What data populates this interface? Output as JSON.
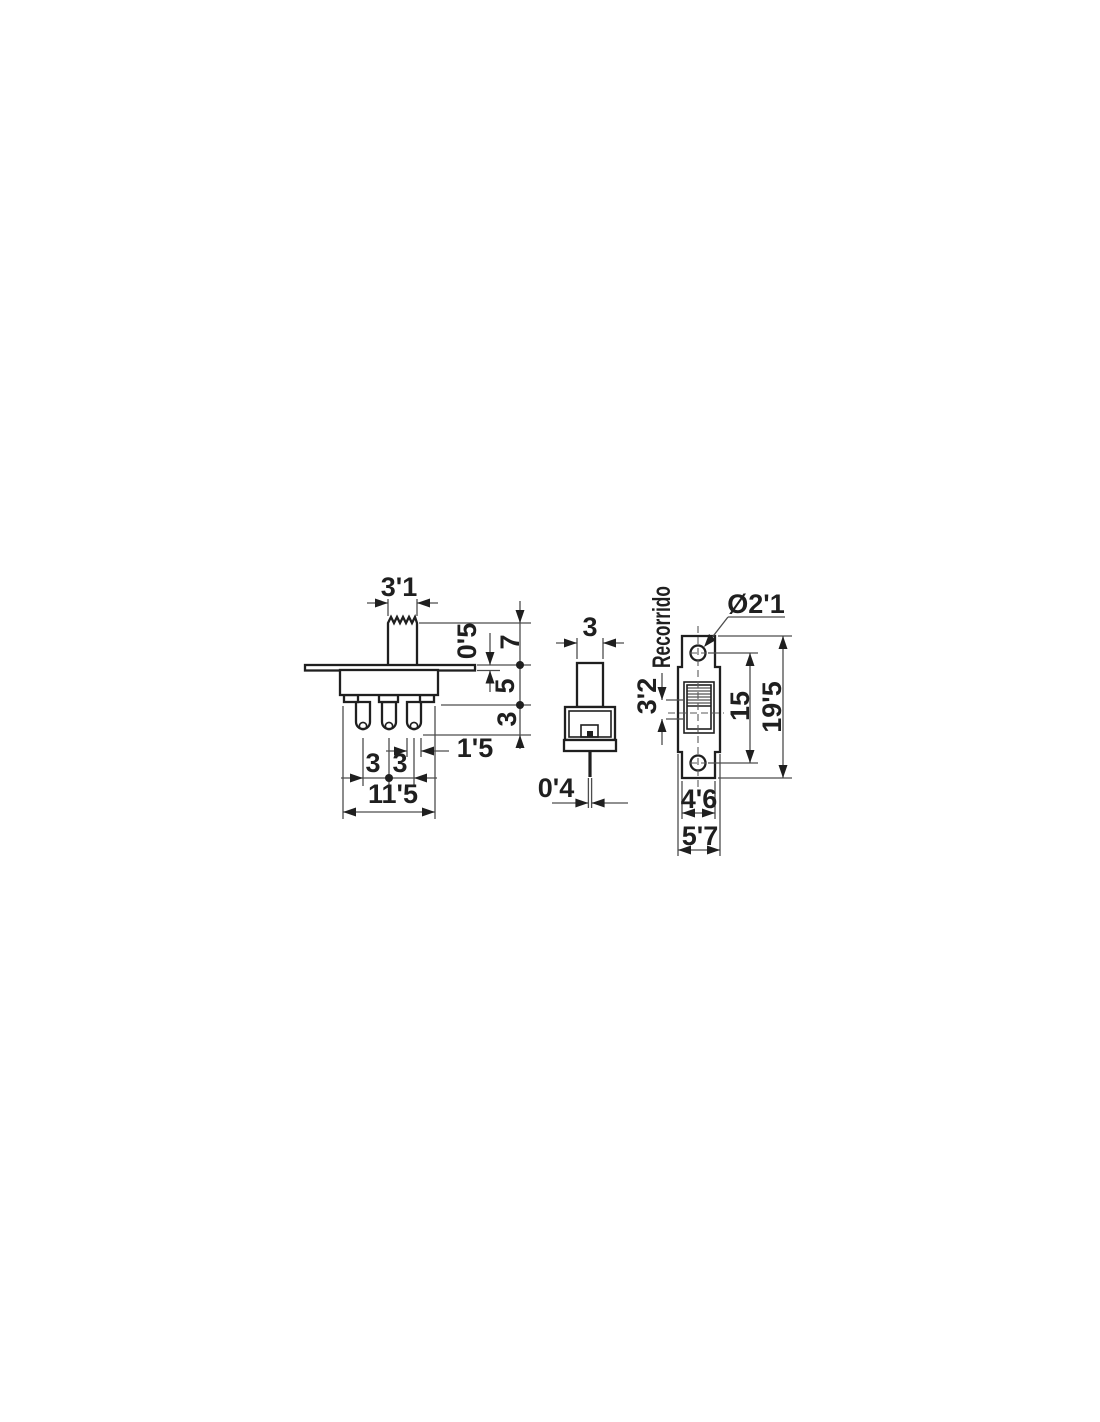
{
  "drawing": {
    "description": "Slide switch dimensional drawing, three views",
    "line_color": "#1f1f1f",
    "dim_color": "#4d4d4d",
    "background": "#ffffff"
  },
  "labels": {
    "front": {
      "actuator_width": "3'1",
      "flange_thickness": "0'5",
      "actuator_height": "7",
      "body_height": "5",
      "terminal_length": "3",
      "terminal_width": "1'5",
      "pin_spacing_a": "3",
      "pin_spacing_b": "3",
      "overall_width": "11'5"
    },
    "side": {
      "actuator_depth": "3",
      "pin_thickness": "0'4"
    },
    "top": {
      "travel_word": "Recorrido",
      "travel": "3'2",
      "hole_diameter": "Ø2'1",
      "hole_spacing": "15",
      "overall_length": "19'5",
      "body_width": "4'6",
      "flange_width": "5'7"
    }
  }
}
